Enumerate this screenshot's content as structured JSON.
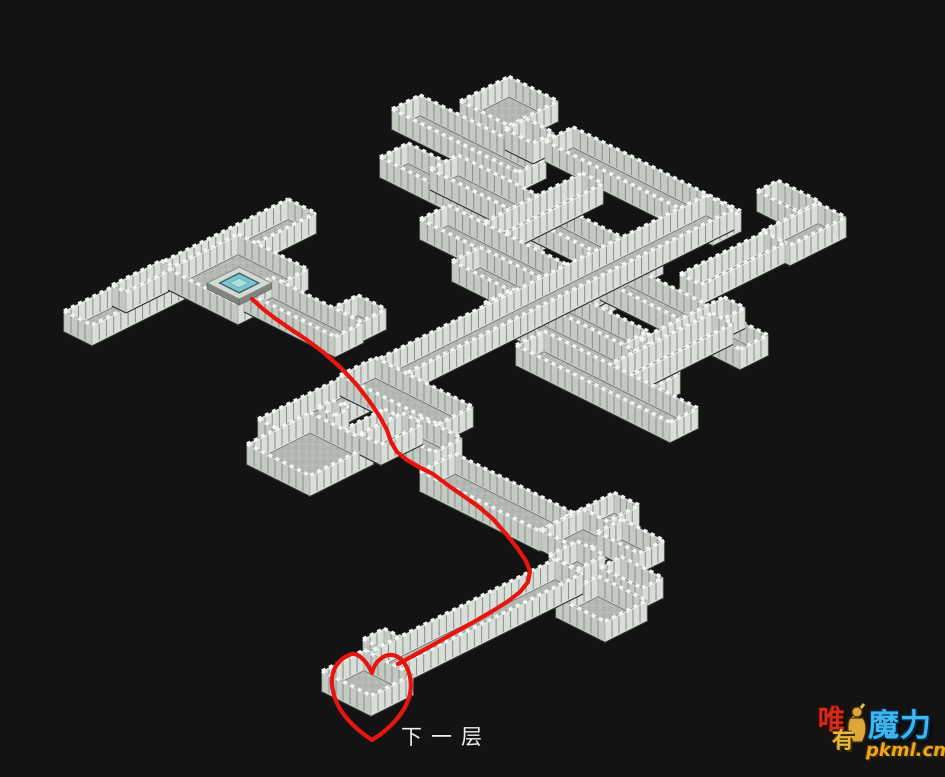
{
  "colors": {
    "background": "#131313",
    "floor": "#b3bab3",
    "wall_face_light": "#d9ded8",
    "wall_face_mid": "#c3cac3",
    "wall_top": "#f3f5f2",
    "wall_tick": "#868e86",
    "wall_stroke": "#99a199",
    "wall_base": "#2b302b",
    "path_red": "#e81410",
    "portal_teal": "#7ec6ce",
    "portal_teal_light": "#abdee3",
    "portal_border": "#3f6168",
    "plinth": "#7e857e",
    "plinth_top": "#d3d9d3"
  },
  "map": {
    "wall_height": 21,
    "floors": [
      {
        "name": "top-room",
        "x": 460,
        "y": 122,
        "a": 3.5,
        "b": 3.5
      },
      {
        "name": "maze-corridor-1",
        "x": 392,
        "y": 130,
        "a": 2,
        "b": 9
      },
      {
        "name": "top-room-door",
        "x": 505,
        "y": 150,
        "a": 1.5,
        "b": 2
      },
      {
        "name": "north-long-corridor",
        "x": 545,
        "y": 162,
        "a": 2,
        "b": 12
      },
      {
        "name": "maze-corridor-2",
        "x": 380,
        "y": 178,
        "a": 2,
        "b": 11
      },
      {
        "name": "hook-room-upper",
        "x": 757,
        "y": 212,
        "a": 1.5,
        "b": 3
      },
      {
        "name": "maze-corridor-3",
        "x": 430,
        "y": 190,
        "a": 2,
        "b": 13
      },
      {
        "name": "hook-room",
        "x": 762,
        "y": 252,
        "a": 4,
        "b": 2
      },
      {
        "name": "maze-cross-1",
        "x": 470,
        "y": 250,
        "a": 8,
        "b": 1.5
      },
      {
        "name": "hook-connector",
        "x": 680,
        "y": 295,
        "a": 6,
        "b": 1.5
      },
      {
        "name": "maze-corridor-4",
        "x": 420,
        "y": 240,
        "a": 2,
        "b": 12
      },
      {
        "name": "northwest-corridor",
        "x": 64,
        "y": 332,
        "a": 16,
        "b": 2
      },
      {
        "name": "west-wall-fragment",
        "x": 112,
        "y": 306,
        "a": 3.5,
        "b": 1
      },
      {
        "name": "portal-room",
        "x": 168,
        "y": 290,
        "a": 5,
        "b": 5
      },
      {
        "name": "maze-cross-2",
        "x": 530,
        "y": 320,
        "a": 8,
        "b": 1.5
      },
      {
        "name": "maze-corridor-5",
        "x": 452,
        "y": 282,
        "a": 2,
        "b": 12
      },
      {
        "name": "maze-corridor-6",
        "x": 600,
        "y": 300,
        "a": 2,
        "b": 10
      },
      {
        "name": "junction-stub",
        "x": 330,
        "y": 330,
        "a": 2,
        "b": 2
      },
      {
        "name": "portal-exit-corridor",
        "x": 244,
        "y": 312,
        "a": 2,
        "b": 6.5
      },
      {
        "name": "maze-corridor-7",
        "x": 484,
        "y": 324,
        "a": 2,
        "b": 12
      },
      {
        "name": "maze-cross-4",
        "x": 640,
        "y": 360,
        "a": 6,
        "b": 1.5
      },
      {
        "name": "grand-diagonal-corridor",
        "x": 258,
        "y": 440,
        "a": 32,
        "b": 2
      },
      {
        "name": "maze-cross-3",
        "x": 600,
        "y": 390,
        "a": 8,
        "b": 1.5
      },
      {
        "name": "maze-corridor-8",
        "x": 516,
        "y": 366,
        "a": 2,
        "b": 11
      },
      {
        "name": "descent-corridor-upper",
        "x": 340,
        "y": 396,
        "a": 2.5,
        "b": 7
      },
      {
        "name": "west-room-stub",
        "x": 318,
        "y": 428,
        "a": 1,
        "b": 1.2
      },
      {
        "name": "side-corridor",
        "x": 300,
        "y": 472,
        "a": 6,
        "b": 2
      },
      {
        "name": "descent-jog",
        "x": 392,
        "y": 452,
        "a": 2,
        "b": 3
      },
      {
        "name": "west-room",
        "x": 247,
        "y": 465,
        "a": 4.5,
        "b": 4.5
      },
      {
        "name": "west-room-connector",
        "x": 360,
        "y": 455,
        "a": 3,
        "b": 1.5
      },
      {
        "name": "descent-corridor-lower",
        "x": 420,
        "y": 492,
        "a": 2.5,
        "b": 8.5
      },
      {
        "name": "cross-north-arm",
        "x": 565,
        "y": 538,
        "a": 3.5,
        "b": 1.8
      },
      {
        "name": "cross-junction",
        "x": 541,
        "y": 551,
        "a": 3,
        "b": 3
      },
      {
        "name": "cross-east-arm",
        "x": 597,
        "y": 553,
        "a": 1.8,
        "b": 3
      },
      {
        "name": "cross-south-arm",
        "x": 549,
        "y": 576,
        "a": 2,
        "b": 2
      },
      {
        "name": "southeast-room-connector",
        "x": 600,
        "y": 588,
        "a": 1.5,
        "b": 3
      },
      {
        "name": "southeast-room",
        "x": 556,
        "y": 618,
        "a": 3,
        "b": 3.5
      },
      {
        "name": "heart-alcove",
        "x": 363,
        "y": 660,
        "a": 1.5,
        "b": 1.5
      },
      {
        "name": "exit-corridor",
        "x": 345,
        "y": 685,
        "a": 15,
        "b": 2
      },
      {
        "name": "exit-room",
        "x": 322,
        "y": 692,
        "a": 3,
        "b": 3.5
      }
    ],
    "portal": {
      "x": 207,
      "y": 289,
      "a": 2.3,
      "b": 2.3,
      "height": 6
    },
    "route": {
      "points": [
        [
          252,
          299
        ],
        [
          263,
          309
        ],
        [
          276,
          319
        ],
        [
          292,
          330
        ],
        [
          307,
          340
        ],
        [
          323,
          352
        ],
        [
          341,
          368
        ],
        [
          357,
          385
        ],
        [
          370,
          402
        ],
        [
          380,
          417
        ],
        [
          387,
          430
        ],
        [
          391,
          442
        ],
        [
          397,
          452
        ],
        [
          407,
          460
        ],
        [
          419,
          467
        ],
        [
          433,
          474
        ],
        [
          449,
          486
        ],
        [
          465,
          497
        ],
        [
          479,
          507
        ],
        [
          493,
          519
        ],
        [
          507,
          535
        ],
        [
          518,
          549
        ],
        [
          526,
          561
        ],
        [
          530,
          571
        ],
        [
          528,
          582
        ],
        [
          520,
          592
        ],
        [
          507,
          602
        ],
        [
          491,
          612
        ],
        [
          472,
          623
        ],
        [
          452,
          634
        ],
        [
          431,
          646
        ],
        [
          411,
          657
        ],
        [
          398,
          664
        ]
      ],
      "heart": "M 372 673 C 366 659 356 651 349 655 C 336 661 329 673 333 691 C 337 712 355 729 372 740 C 390 729 406 712 410 694 C 413 678 407 661 396 656 C 386 652 375 660 372 673 Z",
      "width": 4.2
    }
  },
  "labels": {
    "next_floor": {
      "text": "下一层",
      "x": 401,
      "y": 721
    }
  },
  "watermark": {
    "char1": "唯",
    "char2": "有",
    "brand": "魔力",
    "site": "pkml.cn"
  }
}
